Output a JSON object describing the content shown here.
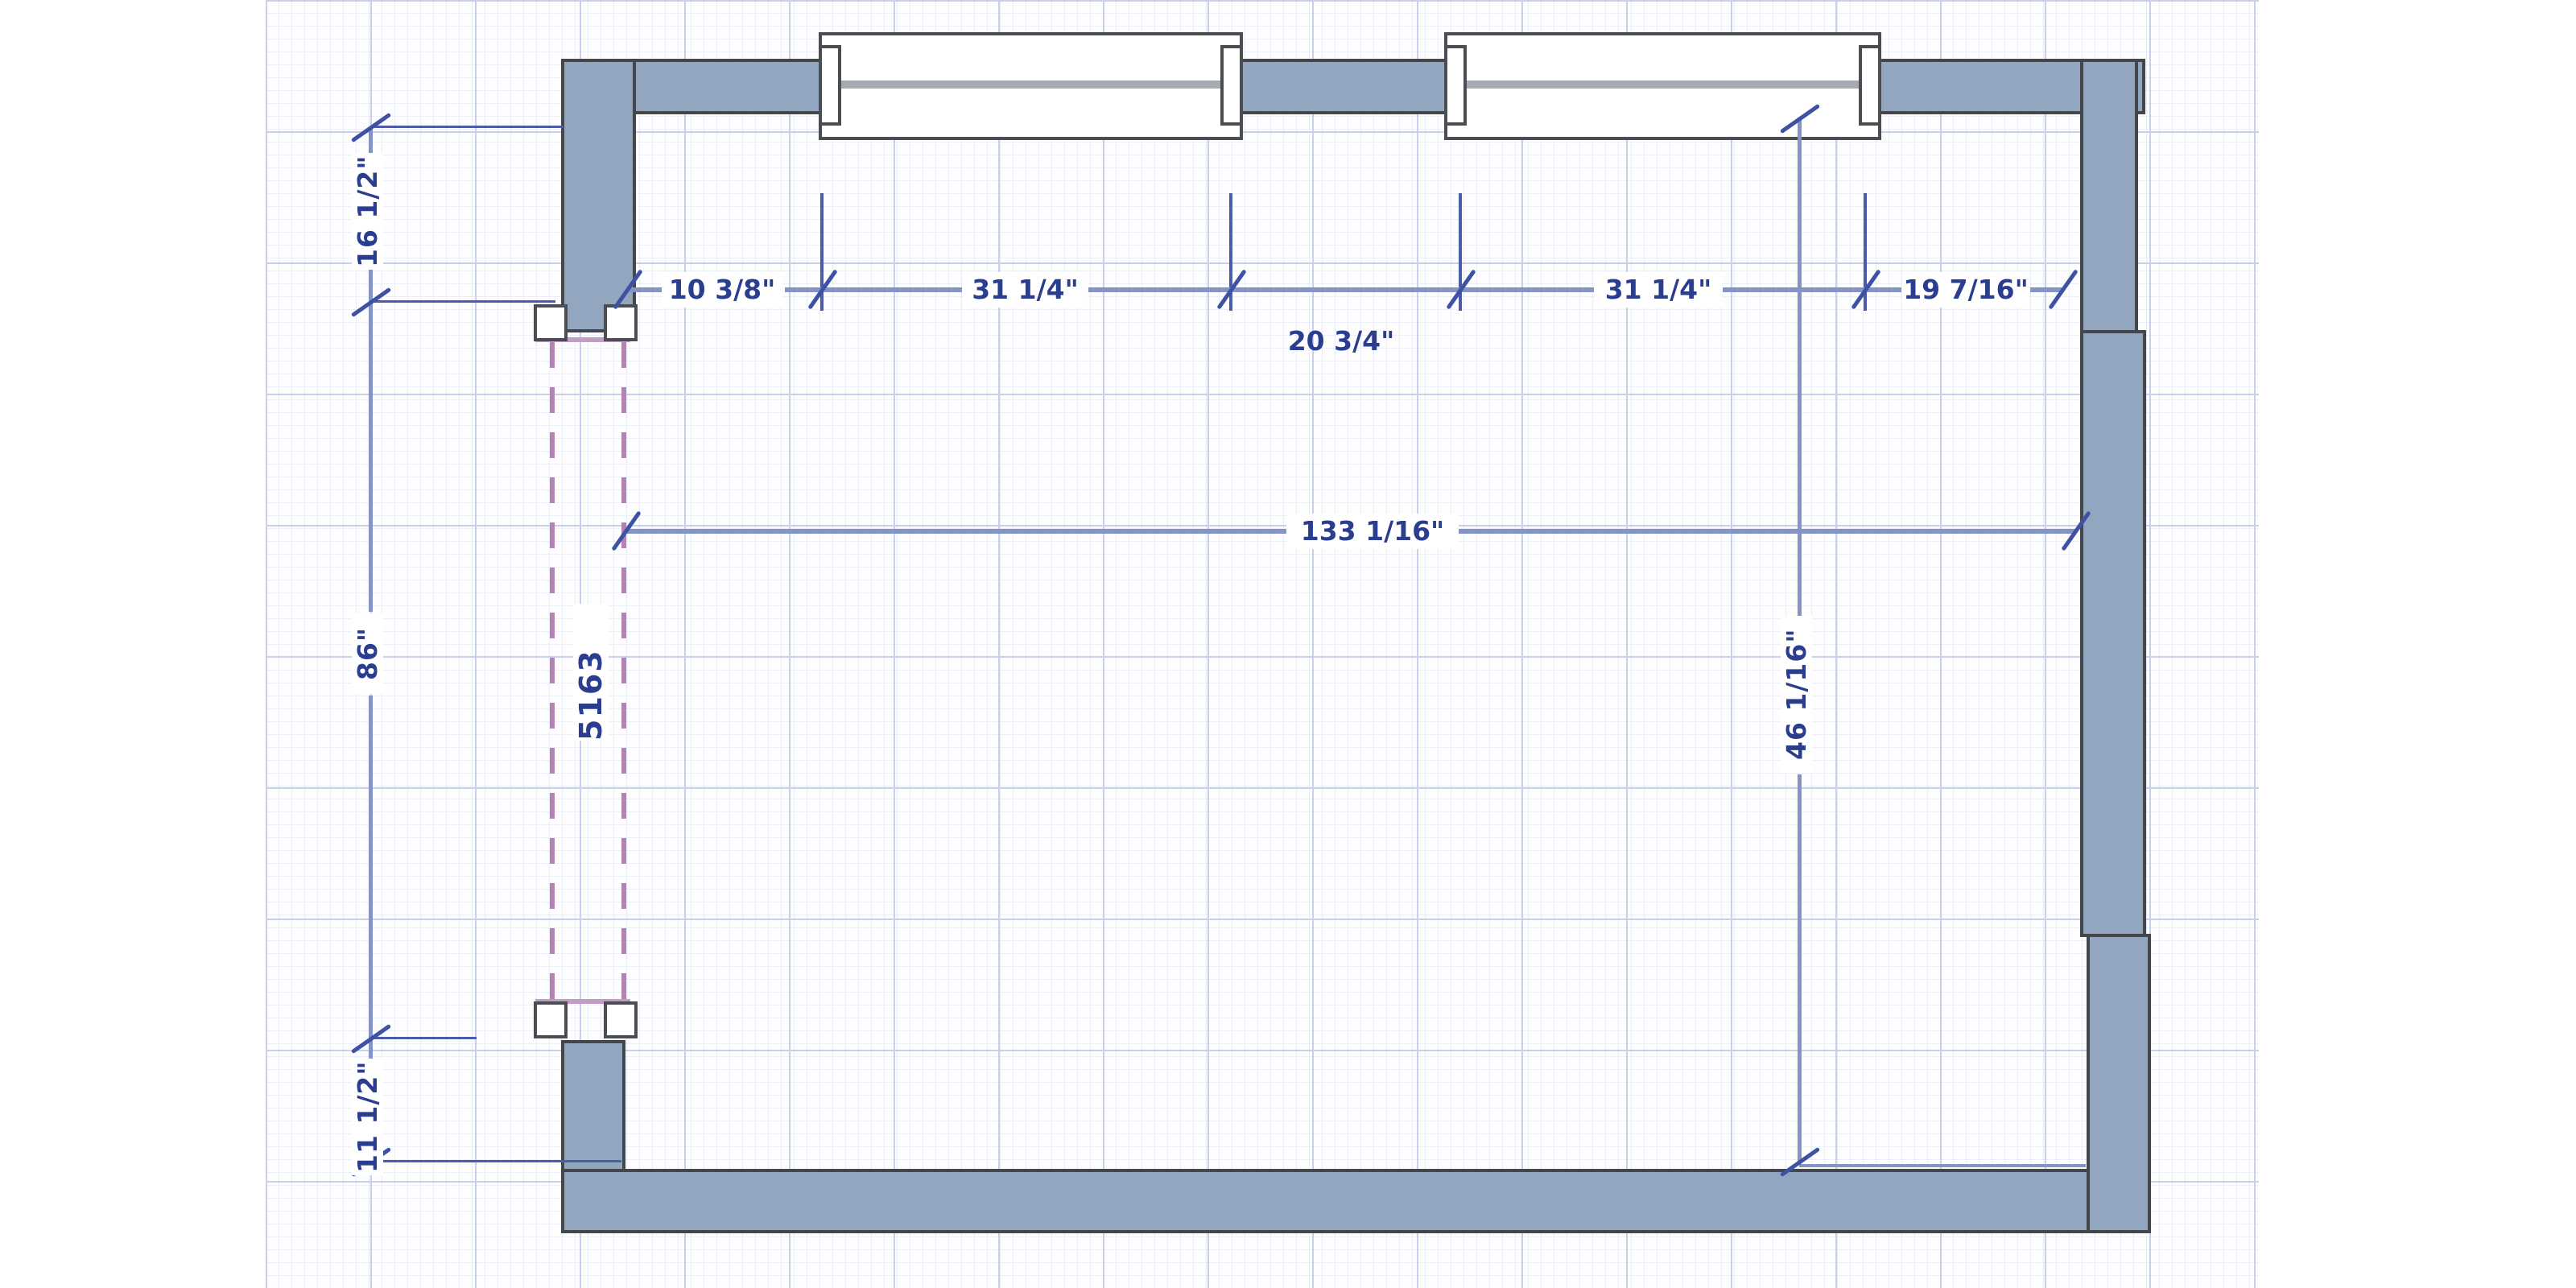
{
  "drawing": {
    "type": "floor-plan",
    "door": {
      "label": "5163"
    },
    "dims": {
      "top_chain": [
        {
          "label": "10 3/8\""
        },
        {
          "label": "31 1/4\""
        },
        {
          "label": "31 1/4\""
        },
        {
          "label": "19 7/16\""
        }
      ],
      "window_center": {
        "label": "20 3/4\""
      },
      "overall_width": {
        "label": "133 1/16\""
      },
      "left_chain": [
        {
          "label": "16 1/2\""
        },
        {
          "label": "86\""
        },
        {
          "label": "11 1/2\""
        }
      ],
      "room_height": {
        "label": "46 1/16\""
      }
    },
    "colors": {
      "wall_fill": "#93a6c0",
      "wall_outline": "#43464b",
      "dim_line": "#8494c4",
      "dim_accent": "#3f51a3",
      "dim_text": "#2b3d8f",
      "door_dash": "#b383b3",
      "grid_major": "#c9d0ec",
      "window_sill": "#a7abb1"
    }
  }
}
